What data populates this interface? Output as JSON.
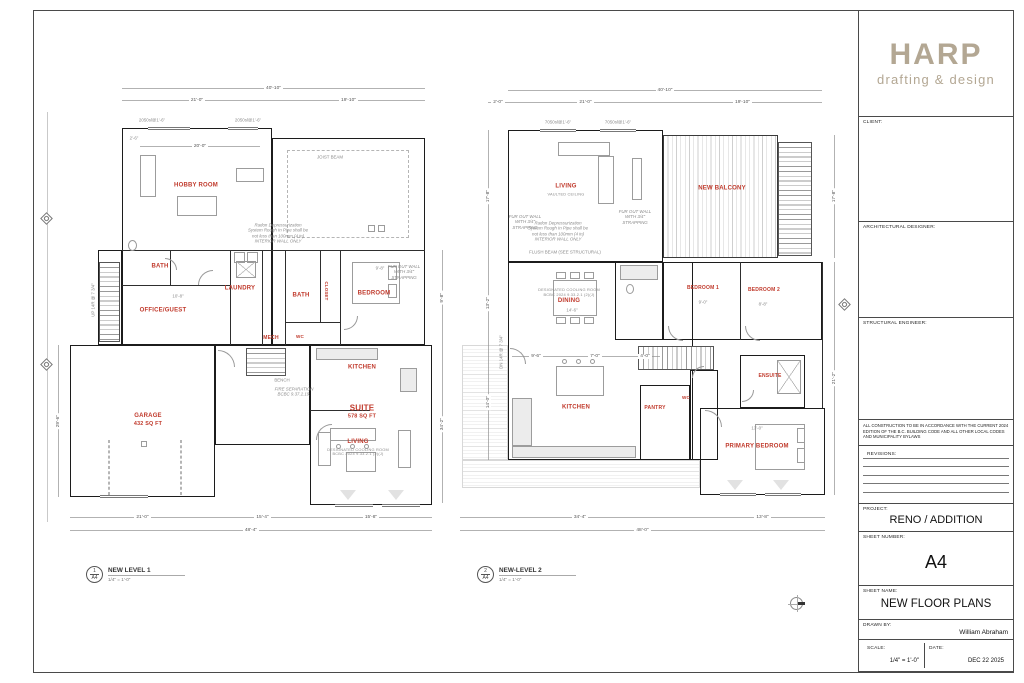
{
  "colors": {
    "accent_red": "#c0392b",
    "logo_tan": "#b3a793",
    "wall_ink": "#1c1c1c",
    "dim_gray": "#8f8f8f"
  },
  "title_block": {
    "logo": {
      "name": "HARP",
      "tagline": "drafting & design"
    },
    "client_label": "CLIENT:",
    "architectural_designer_label": "ARCHITECTURAL DESIGNER:",
    "structural_engineer_label": "STRUCTURAL ENGINEER:",
    "code_note": "ALL CONSTRUCTION TO BE IN ACCORDANCE WITH THE CURRENT 2024 EDITION OF THE B.C. BUILDING CODE AND ALL OTHER LOCAL CODES AND MUNICIPALITY BYLAWS",
    "revisions_label": "REVISIONS:",
    "project_label": "PROJECT:",
    "project": "RENO / ADDITION",
    "sheet_number_label": "SHEET NUMBER:",
    "sheet_number": "A4",
    "sheet_name_label": "SHEET NAME:",
    "sheet_name": "NEW FLOOR PLANS",
    "drawn_by_label": "DRAWN BY:",
    "drawn_by": "William Abraham",
    "scale_label": "SCALE:",
    "scale": "1/4\" = 1'-0\"",
    "date_label": "DATE:",
    "date": "DEC 22 2025"
  },
  "plans": [
    {
      "number": "1",
      "sheet_ref": "A4",
      "caption": "NEW LEVEL 1",
      "scale": "1/4\" = 1'-0\"",
      "rooms": [
        {
          "label": "HOBBY ROOM"
        },
        {
          "label": "BATH"
        },
        {
          "label": "LAUNDRY"
        },
        {
          "label": "BATH"
        },
        {
          "label": "BEDROOM"
        },
        {
          "label": "OFFICE/GUEST"
        },
        {
          "label": "MECH"
        },
        {
          "label": "CLOSET"
        },
        {
          "label": "WC"
        },
        {
          "label": "KITCHEN"
        },
        {
          "label": "GARAGE",
          "sub": "432 SQ FT"
        },
        {
          "label": "SUITE",
          "sub": "578 SQ FT"
        },
        {
          "label": "LIVING",
          "note": "DESIGNATED COOLING ROOM BCBC 2024 9.33.2.1 (2)(J)"
        }
      ],
      "dims": [
        "40'-10\"",
        "21'-0\"",
        "19'-10\"",
        "2'-6\"",
        "20'-0\"",
        "21'-0\"",
        "15'-4\"",
        "15'-8\"",
        "48'-4\"",
        "29'-6\"",
        "9'-8\"",
        "34'-2\"",
        "10'-8\"",
        "9'-8\""
      ],
      "window_tags": [
        "2050sl@1'-6\"",
        "2050sl@1'-6\""
      ],
      "notes": [
        "UP 14R @ 7 3/4\"",
        "Radon Depressurization System Rough In Pipe shall be not less than 100mm (4 in) INTERIOR WALL ONLY",
        "FUR OUT WALL WITH 3/4\" STRAPPING",
        "FIRE SEPARATION BCBC 9.37.2.19.",
        "JOIST BEAM",
        "BENCH"
      ]
    },
    {
      "number": "2",
      "sheet_ref": "A4",
      "caption": "NEW-LEVEL 2",
      "scale": "1/4\" = 1'-0\"",
      "rooms": [
        {
          "label": "LIVING",
          "note": "VAULTED CEILING"
        },
        {
          "label": "NEW BALCONY"
        },
        {
          "label": "DINING",
          "note": "DESIGNATED COOLING ROOM BCBC 2024 9.33.2.1 (2)(J)"
        },
        {
          "label": "BEDROOM 1"
        },
        {
          "label": "BEDROOM 2"
        },
        {
          "label": "KITCHEN"
        },
        {
          "label": "PANTRY"
        },
        {
          "label": "WC"
        },
        {
          "label": "ENSUITE"
        },
        {
          "label": "PRIMARY BEDROOM"
        }
      ],
      "dims": [
        "40'-10\"",
        "2'-0\"",
        "21'-0\"",
        "19'-10\"",
        "34'-4\"",
        "13'-8\"",
        "48'-0\"",
        "17'-8\"",
        "13'-2\"",
        "14'-0\"",
        "17'-8\"",
        "21'-2\"",
        "14'-6\"",
        "9'-0\"",
        "8'-8\"",
        "13'-0\"",
        "9'-6\"",
        "7'-0\"",
        "4'-0\""
      ],
      "window_tags": [
        "7050sl@1'-6\"",
        "7050sl@1'-6\""
      ],
      "notes": [
        "DN 14R @ 7 3/4\"",
        "Radon Depressurization System Rough In Pipe shall be not less than 100mm (4 in) INTERIOR WALL ONLY",
        "FUR OUT WALL WITH 3/4\" STRAPPING",
        "FLUSH BEAM (SEE STRUCTURAL)",
        "FUR OUT WALL WITH 3/4\" STRAPPING"
      ]
    }
  ]
}
